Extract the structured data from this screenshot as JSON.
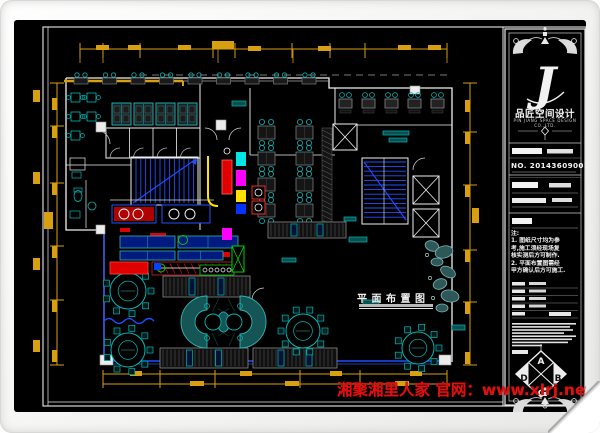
{
  "page": {
    "kind": "CAD restaurant floor-plan sheet",
    "sheet_background": "#000000"
  },
  "plan": {
    "title": "平面布置图"
  },
  "title_block": {
    "logo_letter": "J",
    "company_name": "品匠空间设计",
    "company_sub": "PIN JIANG SPACE DESIGN CO.,LTD.",
    "project_no": "NO. 20143609001",
    "notes": "注:\n1. 图纸尺寸均为参\n考,施工须经现场复\n核实测后方可制作.\n2. 平面布置图需经\n甲方确认后方可施工."
  },
  "compass": {
    "top": "A",
    "right": "B",
    "bottom": "C",
    "left": "D"
  },
  "watermark": {
    "text": "湘聚湘里人家 官网：www.xlrj.net"
  },
  "colors": {
    "canvas_bg": "#000000",
    "frame_line": "#e8e8e8",
    "wall_white": "#f0f0f0",
    "dim_gold": "#d8a010",
    "furn_cyan": "#00b8b8",
    "bright_cyan": "#00e5e5",
    "teal_fill": "#155555",
    "teal_edge": "#2fb5b5",
    "booth_dark": "#161616",
    "slat_gray": "#8a8a8a",
    "stair_blue": "#1f4fff",
    "navy_fill": "#001a80",
    "red": "#e00000",
    "magenta": "#ff00ff",
    "green": "#00d000",
    "yellow": "#ffe000",
    "watermark_red": "#e01010"
  }
}
